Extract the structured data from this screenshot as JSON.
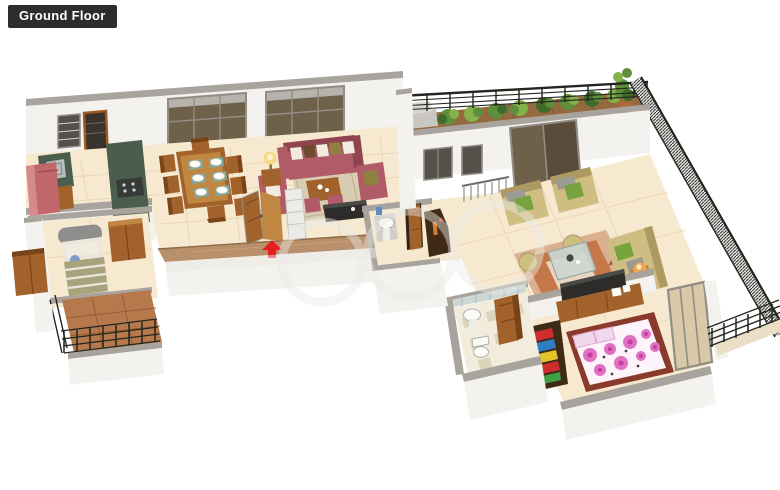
{
  "badge": {
    "label": "Ground Floor"
  },
  "colors": {
    "label_bg": "#2e2d2b",
    "label_text": "#ffffff",
    "wall_face": "#f3f2ef",
    "wall_shade": "#e9e7e2",
    "wall_cap": "#a8a49d",
    "floor_cream": "#f6e9cf",
    "floor_line": "#e4d0aa",
    "entrance_path": "#b8906b",
    "balcony_floor": "#b5794c",
    "balcony_line": "#8f5530",
    "terrace_deck": "#956940",
    "deck_line": "#7a5130",
    "railing_dark": "#23251f",
    "plant_dark": "#3e6b29",
    "plant_mid": "#5d8f3c",
    "plant_light": "#85b14a",
    "counter_green": "#4b5d4c",
    "sink_gray": "#b9bdbd",
    "stove_dark": "#373b37",
    "fridge_red": "#c2686c",
    "wood": "#a2622b",
    "wood_dark": "#7a4418",
    "wood_light": "#c08743",
    "sofa_maroon": "#b15b68",
    "sofa_maroon_dark": "#8f4450",
    "cushion_white": "#f1ecdf",
    "cushion_brown": "#6e4a2e",
    "cushion_olive": "#8f803f",
    "rug_living": "#d8cdb2",
    "sofa_beige": "#cfbe82",
    "sofa_beige_dark": "#ac9a62",
    "cushion_green": "#78a23d",
    "cushion_gray": "#9b9b95",
    "rug_drawing_base": "#dab091",
    "rug_drawing_accent": "#c4784a",
    "glass_table": "#ccd7d1",
    "tv_dark": "#2d2c2a",
    "stairs_green": "#a2b4a5",
    "stairs_line": "#7e9383",
    "fixture_white": "#fbfbf8",
    "fixture_line": "#b0b0a8",
    "tile_wall": "#cdd7d6",
    "bath_floor": "#f2ecdd",
    "bath_check": "#dbd3ba",
    "bed_head_gray": "#8e8e8c",
    "pillow_blue": "#7c9ac9",
    "blanket_olive": "#a9a37c",
    "mattress": "#eae6da",
    "bed_frame": "#8a3a2a",
    "floral_base": "#fdf4fb",
    "floral_pink": "#e070c0",
    "floral_deep": "#c33fa4",
    "clothes_red": "#cc2f2f",
    "clothes_blue": "#2e7fc2",
    "clothes_yellow": "#e6c32a",
    "clothes_green": "#3fa04a",
    "wardrobe_dark": "#3f2a16",
    "lamp_glow": "#f5d98a",
    "lamp_orange": "#f0a44e",
    "arrow_red": "#e51f1f",
    "window_dark": "#55504a",
    "window_glass_brown": "#6f604a",
    "window_frame": "#918d85",
    "window_tint": "#d9c9a8",
    "watermark": "#eceae6"
  },
  "scene": {
    "floor_name": "Ground Floor",
    "view": "3d-isometric-floor-plan",
    "rooms": [
      {
        "name": "kitchen",
        "items": [
          "refrigerator",
          "granite-counter-with-sink",
          "granite-counter-with-hob",
          "window-with-grill",
          "utility-opening"
        ]
      },
      {
        "name": "dining-room",
        "items": [
          "eight-seater-wooden-table",
          "dinner-plates",
          "french-window",
          "french-window"
        ]
      },
      {
        "name": "living-room",
        "items": [
          "maroon-three-seater-sofa",
          "maroon-armchair",
          "maroon-armchair",
          "wooden-coffee-table",
          "rug",
          "ottoman",
          "ottoman",
          "table-lamp",
          "tv-console",
          "display-shelf",
          "main-entrance-double-door",
          "red-entry-arrow"
        ]
      },
      {
        "name": "bedroom-left",
        "items": [
          "single-bed",
          "grey-headboard",
          "blue-round-pillow",
          "wooden-wardrobe",
          "wooden-wardrobe",
          "foot-bench"
        ]
      },
      {
        "name": "balcony-left",
        "items": [
          "terracotta-tile-floor",
          "dark-metal-railing"
        ]
      },
      {
        "name": "hallway",
        "items": [
          "wash-basin",
          "wooden-door",
          "dark-console-table",
          "staircase-with-railing"
        ]
      },
      {
        "name": "terrace",
        "items": [
          "wooden-deck",
          "row-of-shrubs",
          "black-metal-railing",
          "tall-potted-plant",
          "grey-utility-boxes"
        ]
      },
      {
        "name": "drawing-room",
        "items": [
          "beige-armchair",
          "beige-armchair",
          "beige-sofa",
          "glass-coffee-table",
          "patterned-rug",
          "pouf",
          "pouf",
          "orange-floor-lamp",
          "dark-sliding-glass-doors",
          "window",
          "window"
        ]
      },
      {
        "name": "bedroom-right",
        "items": [
          "double-bed-pink-floral-sheet",
          "wall-tv",
          "wooden-tv-unit",
          "open-wardrobe-with-colorful-clothes",
          "sliding-glass-window",
          "side-balcony-railing"
        ]
      },
      {
        "name": "bathroom",
        "items": [
          "wash-basin",
          "toilet",
          "wooden-door",
          "checkered-tile-floor",
          "tiled-wall"
        ]
      }
    ]
  }
}
